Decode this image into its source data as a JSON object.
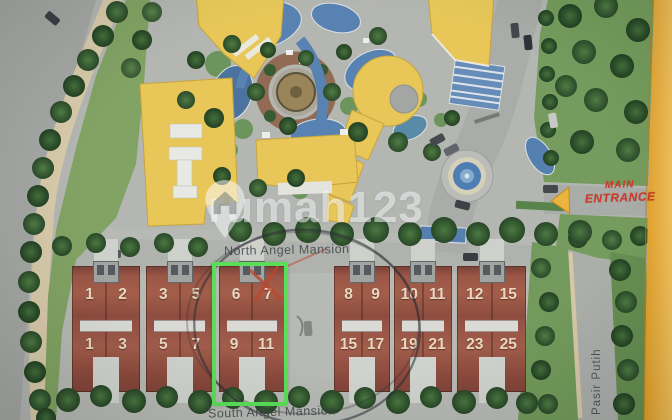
{
  "brand_watermark": {
    "text": "rumah123",
    "icon": "map-pin-house-icon"
  },
  "site_labels": {
    "north_row": "North Angel Mansion",
    "south_row": "South Angel Mansion",
    "entrance_line1": "MAIN",
    "entrance_line2": "ENTRANCE",
    "street_right": "Pasir Putih"
  },
  "housing": {
    "blocks": [
      {
        "north_units": [
          "1",
          "2"
        ],
        "south_units": [
          "1",
          "3"
        ],
        "highlighted": false
      },
      {
        "north_units": [
          "3",
          "5"
        ],
        "south_units": [
          "5",
          "7"
        ],
        "highlighted": false
      },
      {
        "north_units": [
          "6",
          "7"
        ],
        "south_units": [
          "9",
          "11"
        ],
        "highlighted": true
      },
      {
        "north_units": [
          "8",
          "9"
        ],
        "south_units": [
          "15",
          "17"
        ],
        "highlighted": false
      },
      {
        "north_units": [
          "10",
          "11"
        ],
        "south_units": [
          "19",
          "21"
        ],
        "highlighted": false
      },
      {
        "north_units": [
          "12",
          "15"
        ],
        "south_units": [
          "23",
          "25"
        ],
        "highlighted": false
      }
    ]
  },
  "annotations": {
    "highlight_box_units": [
      "6",
      "7",
      "9",
      "11"
    ],
    "highlight_box_color": "#4ce24a",
    "pen_circle_color": "#20222a",
    "red_x_color": "#c23c1e"
  },
  "palette": {
    "building_yellow": "#ecc748",
    "roof_red": "#99493a",
    "pool_blue": "#4d7db3",
    "lawn_green": "#6d9a52",
    "board_edge_orange": "#eda51e",
    "entrance_text_red": "#d5301a"
  }
}
